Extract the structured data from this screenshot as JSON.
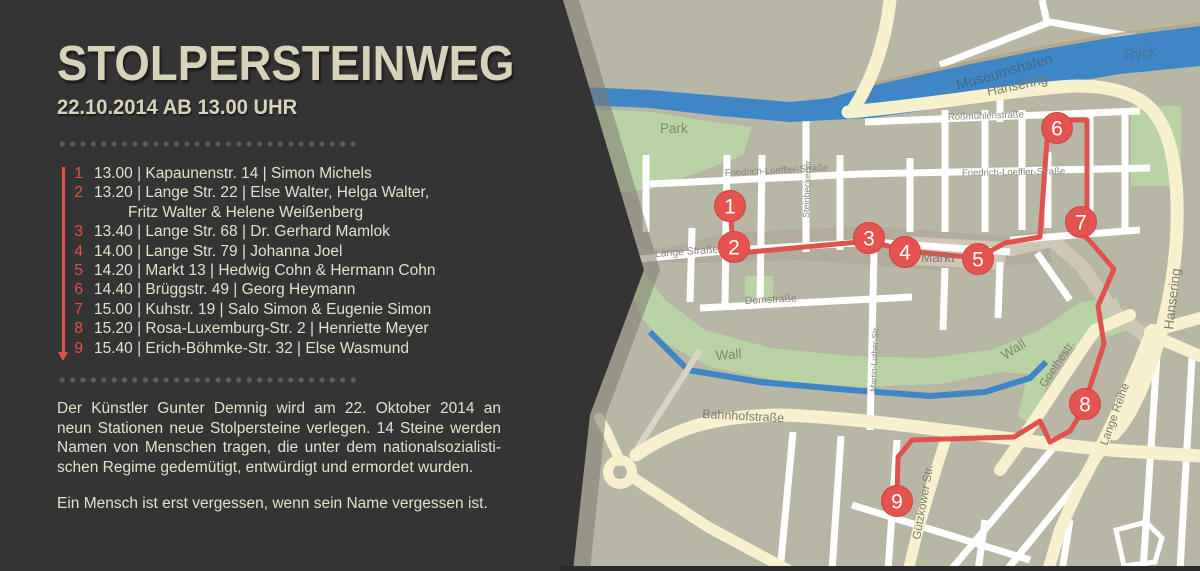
{
  "panel": {
    "title": "STOLPERSTEINWEG",
    "subtitle": "22.10.2014 AB 13.00 UHR",
    "stations": [
      {
        "num": "1",
        "text": "13.00 | Kapaunenstr. 14 | Simon Michels"
      },
      {
        "num": "2",
        "text": "13.20 | Lange Str. 22 | Else Walter, Helga Walter,",
        "text2": "Fritz Walter & Helene Weißenberg"
      },
      {
        "num": "3",
        "text": "13.40 | Lange Str. 68 | Dr. Gerhard Mamlok"
      },
      {
        "num": "4",
        "text": "14.00 | Lange Str. 79 | Johanna Joel"
      },
      {
        "num": "5",
        "text": "14.20 | Markt 13 | Hedwig Cohn & Hermann Cohn"
      },
      {
        "num": "6",
        "text": "14.40 | Brüggstr. 49 | Georg Heymann"
      },
      {
        "num": "7",
        "text": "15.00 | Kuhstr. 19 | Salo Simon & Eugenie Simon"
      },
      {
        "num": "8",
        "text": "15.20 | Rosa-Luxemburg-Str. 2 | Henriette Meyer"
      },
      {
        "num": "9",
        "text": "15.40 | Erich-Böhmke-Str. 32 | Else Wasmund"
      }
    ],
    "paragraph_lines": [
      "Der Künstler Gunter Demnig wird am 22. Oktober 2014 an",
      "neun Stationen neue Stolpersteine verlegen. 14 Steine werden",
      "Namen von Menschen tragen, die unter dem nationalsozialisti-",
      "schen Regime gedemütigt, entwürdigt und ermordet wurden."
    ],
    "closing": "Ein Mensch ist erst vergessen, wenn sein Name vergessen ist."
  },
  "map": {
    "markers": [
      {
        "label": "1"
      },
      {
        "label": "2"
      },
      {
        "label": "3"
      },
      {
        "label": "4"
      },
      {
        "label": "5"
      },
      {
        "label": "6"
      },
      {
        "label": "7"
      },
      {
        "label": "8"
      },
      {
        "label": "9"
      }
    ],
    "labels": {
      "park": "Park",
      "ryck": "Ryck",
      "museumshafen": "Museumshafen",
      "hansering_top": "Hansering",
      "hansering_right": "Hansering",
      "rossmuehlen": "Roßmühlenstraße",
      "friedrich_w": "Friedrich-Loeffler-Straße",
      "friedrich_e": "Friedrich-Loeffler-Straße",
      "steinbecker": "Steinbeckerstr.",
      "lange_strasse": "Lange Straße",
      "domstrasse": "Domstraße",
      "markt": "Markt",
      "martin_luther": "Martin-Luther-Str.",
      "wall_w": "Wall",
      "wall_e": "Wall",
      "goethestr": "Goethestr.",
      "lange_reihe": "Lange Reihe",
      "bahnhofstrasse": "Bahnhofstraße",
      "guetzkower": "Gützkower Str."
    },
    "colors": {
      "panel_bg": "#343434",
      "cream_text": "#e3e0cc",
      "accent_red": "#e0514a",
      "map_bg": "#b8b7a6",
      "water": "#3f86c7",
      "green": "#b9d3a4",
      "road_main": "#f7f2cd",
      "street": "#ffffff",
      "route": "#e2524d"
    }
  }
}
